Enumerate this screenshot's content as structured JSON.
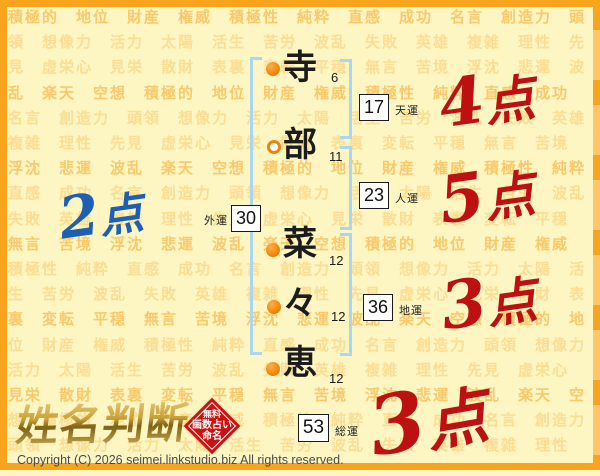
{
  "page": {
    "title": "姓名判断"
  },
  "watermark": {
    "words": [
      "積極的",
      "地位",
      "財産",
      "権威",
      "積極性",
      "純粋",
      "直感",
      "成功",
      "名言",
      "創造力",
      "頭領",
      "想像力",
      "活力",
      "太陽",
      "活生",
      "苦労",
      "波乱",
      "失敗",
      "英雄",
      "複雑",
      "理性",
      "先見",
      "虚栄心",
      "見栄",
      "散財",
      "表裏",
      "変転",
      "平穏",
      "無言",
      "苦境",
      "浮沈",
      "悲運",
      "波乱",
      "楽天",
      "空想"
    ]
  },
  "name": {
    "characters": [
      {
        "char": "寺",
        "strokes": "6"
      },
      {
        "char": "部",
        "strokes": "11"
      },
      {
        "char": "菜",
        "strokes": "12"
      },
      {
        "char": "々",
        "strokes": "12"
      },
      {
        "char": "恵",
        "strokes": "12"
      }
    ]
  },
  "fortunes": [
    {
      "label": "天運",
      "value": "17",
      "score": "4点"
    },
    {
      "label": "人運",
      "value": "23",
      "score": "5点"
    },
    {
      "label": "地運",
      "value": "36",
      "score": "3点"
    },
    {
      "label": "外運",
      "value": "30",
      "score": "2点"
    },
    {
      "label": "総運",
      "value": "53",
      "score": "3点"
    }
  ],
  "colors": {
    "score_red": "#bd1111",
    "score_blue": "#1d5fb2",
    "accent_orange": "#f8a41d",
    "bracket_blue": "#a9d7f3",
    "stamp_red": "#cd1111"
  },
  "logo": {
    "text": "姓名判断",
    "stamp_line1": "無料",
    "stamp_line2": "画数占い",
    "stamp_line3": "命名"
  },
  "footer": {
    "copyright": "Copyright (C) 2026 seimei.linkstudio.biz All rights reserved."
  }
}
